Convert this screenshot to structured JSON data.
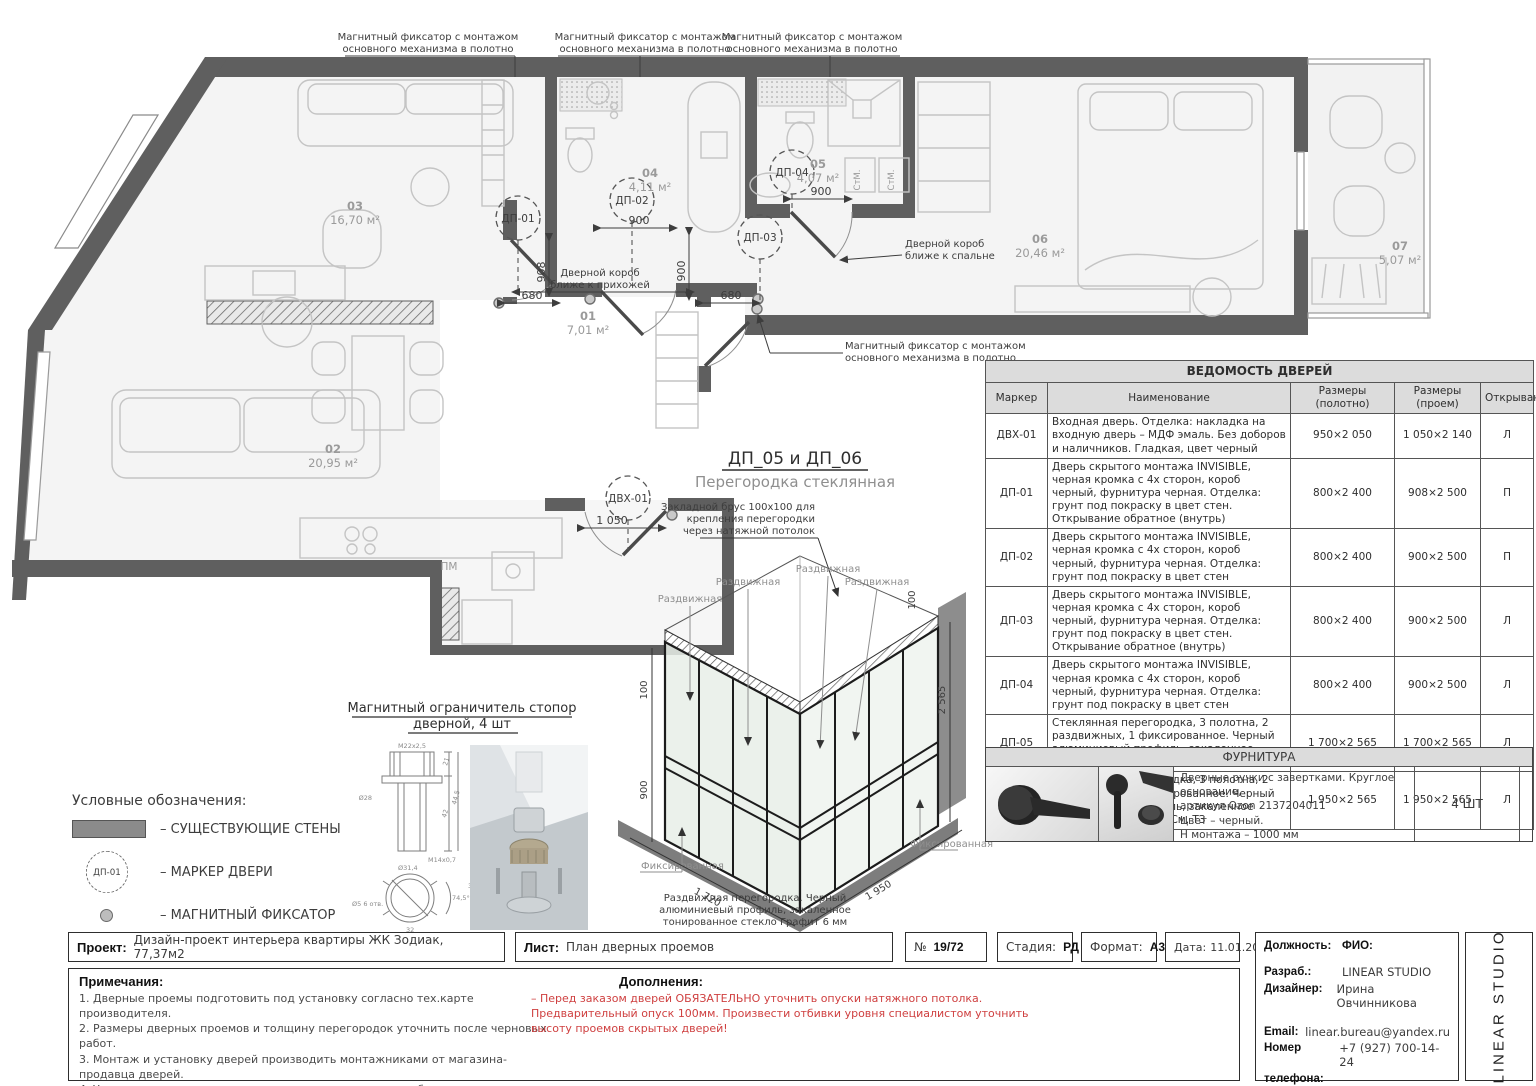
{
  "colors": {
    "wall": "#5f5f5f",
    "red_note": "#cf4040",
    "furniture_line": "#c4c4c4",
    "header_bg": "#dcdcdc"
  },
  "plan": {
    "fixator_l1": "Магнитный фиксатор с монтажом",
    "fixator_l2": "основного механизма в полотно",
    "door_box_hall_l1": "Дверной короб",
    "door_box_hall_l2": "ближе к прихожей",
    "door_box_bed_l1": "Дверной короб",
    "door_box_bed_l2": "ближе к спальне",
    "rooms": {
      "r01": {
        "num": "01",
        "area": "7,01 м²"
      },
      "r02": {
        "num": "02",
        "area": "20,95 м²"
      },
      "r03": {
        "num": "03",
        "area": "16,70 м²"
      },
      "r04": {
        "num": "04",
        "area": "4,11 м²"
      },
      "r05": {
        "num": "05",
        "area": "4,07 м²"
      },
      "r06": {
        "num": "06",
        "area": "20,46 м²"
      },
      "r07": {
        "num": "07",
        "area": "5,07 м²"
      }
    },
    "markers": {
      "dp01": "ДП-01",
      "dp02": "ДП-02",
      "dp03": "ДП-03",
      "dp04": "ДП-04",
      "dvh01": "ДВХ-01"
    },
    "dims": {
      "d908": "908",
      "d680a": "680",
      "d680b": "680",
      "d900a": "900",
      "d900b": "900",
      "d900c": "900",
      "d1050": "1 050"
    },
    "misc": {
      "pm": "ПМ",
      "stm": "СтМ."
    }
  },
  "partition": {
    "title": "ДП_05 и ДП_06",
    "subtitle": "Перегородка стеклянная",
    "note_top_l1": "Закладной брус 100х100 для",
    "note_top_l2": "крепления перегородки",
    "note_top_l3": "через натяжной потолок",
    "sliding": "Раздвижная",
    "fixed": "Фиксированная",
    "dims": {
      "h": "2 565",
      "beam": "100",
      "mid": "900",
      "wl": "1 720",
      "wr": "1 950"
    },
    "note_bottom_l1": "Раздвижная перегородка. Черный",
    "note_bottom_l2": "алюминиевый профиль, закаленное",
    "note_bottom_l3": "тонированное стекло Графит 6 мм"
  },
  "stopper": {
    "title_l1": "Магнитный ограничитель стопор",
    "title_l2": "дверной, 4 шт",
    "dims": {
      "thread_top": "М22х2,5",
      "d28": "Ø28",
      "m14": "М14х0,7",
      "d314": "Ø31,4",
      "d5": "Ø5  6 отв.",
      "h21": "21",
      "h42": "42",
      "h445": "44,5",
      "w32": "32",
      "a745": "74,5°",
      "w36": "36"
    }
  },
  "legend": {
    "title": "Условные обозначения:",
    "wall": "–  СУЩЕСТВУЮЩИЕ СТЕНЫ",
    "marker_tag": "ДП-01",
    "marker": "–  МАРКЕР ДВЕРИ",
    "magnet": "–  МАГНИТНЫЙ ФИКСАТОР"
  },
  "schedule": {
    "title": "ВЕДОМОСТЬ ДВЕРЕЙ",
    "col_marker": "Маркер",
    "col_name": "Наименование",
    "col_leaf": "Размеры (полотно)",
    "col_opening": "Размеры (проем)",
    "col_swing": "Открывание",
    "rows": [
      {
        "m": "ДВХ-01",
        "n": "Входная дверь. Отделка: накладка на входную дверь – МДФ эмаль. Без доборов и наличников. Гладкая, цвет черный",
        "l": "950×2 050",
        "o": "1 050×2 140",
        "s": "Л"
      },
      {
        "m": "ДП-01",
        "n": "Дверь скрытого монтажа INVISIBLE, черная кромка с 4х сторон, короб черный, фурнитура черная. Отделка: грунт под покраску в цвет стен. Открывание обратное (внутрь)",
        "l": "800×2 400",
        "o": "908×2 500",
        "s": "П"
      },
      {
        "m": "ДП-02",
        "n": "Дверь скрытого монтажа INVISIBLE, черная кромка с 4х сторон, короб черный, фурнитура черная. Отделка: грунт под покраску в цвет стен",
        "l": "800×2 400",
        "o": "900×2 500",
        "s": "П"
      },
      {
        "m": "ДП-03",
        "n": "Дверь скрытого монтажа INVISIBLE, черная кромка с 4х сторон, короб черный, фурнитура черная. Отделка: грунт под покраску в цвет стен. Открывание обратное (внутрь)",
        "l": "800×2 400",
        "o": "900×2 500",
        "s": "Л"
      },
      {
        "m": "ДП-04",
        "n": "Дверь скрытого монтажа INVISIBLE, черная кромка с 4х сторон, короб черный, фурнитура черная. Отделка: грунт под покраску в цвет стен",
        "l": "800×2 400",
        "o": "900×2 500",
        "s": "Л"
      },
      {
        "m": "ДП-05",
        "n": "Стеклянная перегородка, 3 полотна, 2 раздвижных, 1 фиксированное. Черный алюминиевый профиль, закаленное стекло Графит 6 мм. См. ТЗ",
        "l": "1 700×2 565",
        "o": "1 700×2 565",
        "s": "Л"
      },
      {
        "m": "ДП-06",
        "n": "Стеклянная перегородка, 3 полотна, 2 раздвижных, 1 фиксированное. Черный алюминиевый профиль, закаленное стекло Графит 6 мм. См. ТЗ",
        "l": "1 950×2 565",
        "o": "1 950×2 565",
        "s": "Л"
      }
    ]
  },
  "hardware": {
    "title": "ФУРНИТУРА",
    "desc_l1": "Дверные ручки с завертками. Круглое основание,",
    "desc_l2": "артикул Ozon 2137204011",
    "desc_l3": "Цвет – черный.",
    "desc_l4": "Н монтажа – 1000 мм",
    "qty": "4 ШТ"
  },
  "titlebar": {
    "project_label": "Проект:",
    "project": "Дизайн-проект интерьера квартиры ЖК Зодиак, 77,37м2",
    "sheet_label": "Лист:",
    "sheet": "План дверных проемов",
    "num_label": "№",
    "num": "19/72",
    "stage_label": "Стадия:",
    "stage": "РД",
    "format_label": "Формат:",
    "format": "А3",
    "date_label": "Дата:",
    "date": "11.01.2026"
  },
  "info": {
    "pos_label": "Должность:",
    "fio_label": "ФИО:",
    "dev_label": "Разраб.:",
    "dev": "LINEAR STUDIO",
    "designer_label": "Дизайнер:",
    "designer": "Ирина Овчинникова",
    "email_label": "Email:",
    "email": "linear.bureau@yandex.ru",
    "phone_label1": "Номер",
    "phone_label2": "телефона:",
    "phone": "+7 (927) 700-14-24",
    "studio_vertical": "LINEAR STUDIO"
  },
  "notes": {
    "title": "Примечания:",
    "items": [
      "1. Дверные проемы подготовить под установку согласно тех.карте производителя.",
      "2. Размеры дверных проемов и толщину перегородок уточнить после черновых работ.",
      "3. Монтаж и установку дверей производить монтажниками от магазина-продавца дверей.",
      "4. Уточнить размер проема под скрытые двери после подбора напольного покрытия учитывая его толщину."
    ],
    "item5_red": "5. Короба скрытых дверей установить вровень с чистовой отделкой стены!"
  },
  "additions": {
    "title": "Дополнения:",
    "lines": [
      "– Перед заказом дверей ОБЯЗАТЕЛЬНО уточнить опуски натяжного потолка.",
      "Предварительный опуск 100мм. Произвести отбивки уровня специалистом уточнить",
      "высоту проемов скрытых дверей!"
    ]
  }
}
